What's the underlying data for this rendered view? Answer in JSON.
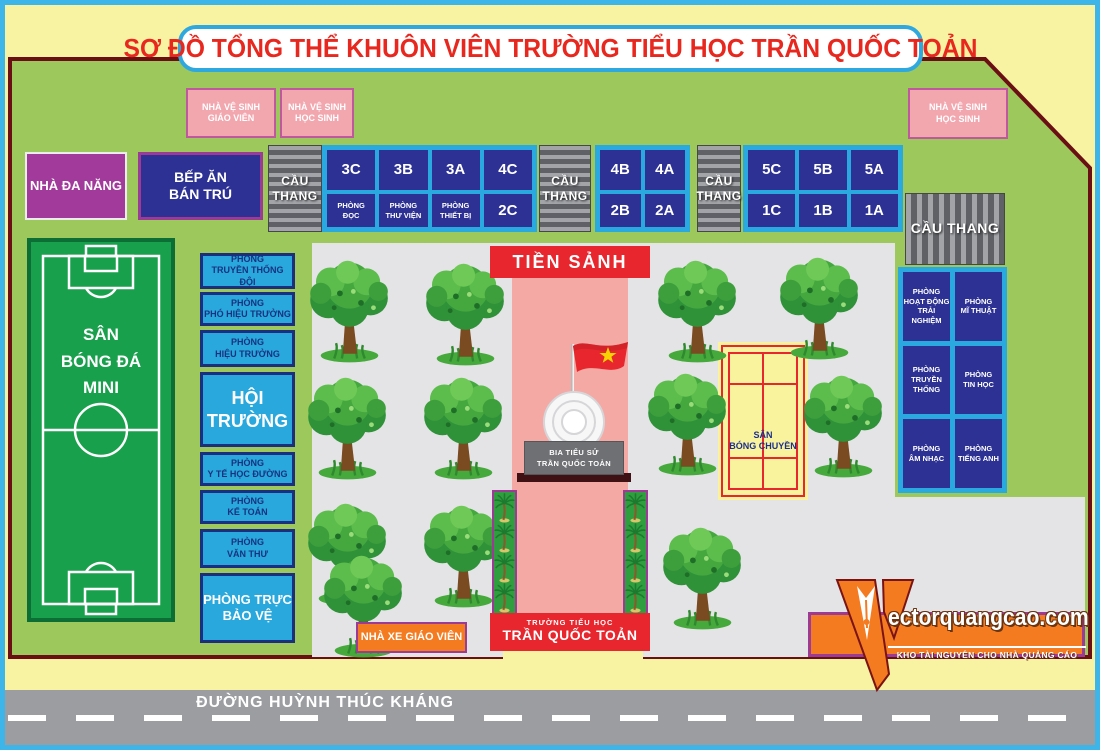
{
  "title": "SƠ ĐỒ TỔNG THỂ KHUÔN VIÊN TRƯỜNG TIỂU HỌC TRẦN QUỐC TOẢN",
  "colors": {
    "outer_border": "#3db5e8",
    "background_yellow": "#f8f3a2",
    "campus_green": "#9dc95c",
    "campus_border_red": "#6a0f14",
    "title_red": "#e8281e",
    "room_navy": "#2c3193",
    "frame_light_blue": "#2aa9e1",
    "toilet_pink": "#f2a6ae",
    "purple": "#a13a9b",
    "orange": "#f47b20",
    "courtyard_gray": "#e4e4e6",
    "walkway_pink": "#f4a9a4",
    "banner_red": "#e8262d",
    "field_green": "#18a04c",
    "court_yellow": "#faf39e",
    "road_gray": "#9b9da1"
  },
  "facilities": {
    "toilet_teacher": "NHÀ VỆ SINH\nGIÁO VIÊN",
    "toilet_student": "NHÀ VỆ SINH\nHỌC SINH",
    "multi_purpose_hall": "NHÀ ĐA NĂNG",
    "kitchen": "BẾP ĂN\nBÁN TRÚ",
    "stairs": "CẦU\nTHANG",
    "stairs_wide": "CẦU THANG",
    "teacher_parking": "NHÀ XE GIÁO VIÊN"
  },
  "classrooms": {
    "block1_top": [
      "3C",
      "3B",
      "3A",
      "4C"
    ],
    "block1_bottom": [
      "PHÒNG\nĐỌC",
      "PHÒNG\nTHƯ VIỆN",
      "PHÒNG\nTHIẾT BỊ",
      "2C"
    ],
    "block2_top": [
      "4B",
      "4A"
    ],
    "block2_bottom": [
      "2B",
      "2A"
    ],
    "block3_top": [
      "5C",
      "5B",
      "5A"
    ],
    "block3_bottom": [
      "1C",
      "1B",
      "1A"
    ]
  },
  "left_rooms": [
    "PHÒNG\nTRUYỀN THỐNG ĐỘI",
    "PHÒNG\nPHÓ HIỆU TRƯỞNG",
    "PHÒNG\nHIỆU TRƯỞNG",
    "HỘI\nTRƯỜNG",
    "PHÒNG\nY TẾ HỌC ĐƯỜNG",
    "PHÒNG\nKẾ TOÁN",
    "PHÒNG\nVĂN THƯ",
    "PHÒNG TRỰC\nBẢO VỆ"
  ],
  "right_rooms": [
    "PHÒNG\nHOẠT ĐỘNG\nTRẢI NGHIỆM",
    "PHÒNG\nMĨ THUẬT",
    "PHÒNG\nTRUYỀN THỐNG",
    "PHÒNG\nTIN HỌC",
    "PHÒNG\nÂM NHẠC",
    "PHÒNG\nTIẾNG ANH"
  ],
  "grounds": {
    "soccer_field": "SÂN\nBÓNG ĐÁ\nMINI",
    "volleyball_court": "SÂN\nBÓNG CHUYỀN",
    "front_hall": "TIỀN SẢNH",
    "memorial": "BIA TIỂU SỬ\nTRẦN QUỐC TOẢN"
  },
  "gate": {
    "line1": "TRƯỜNG TIỂU HỌC",
    "line2": "TRẦN QUỐC TOẢN"
  },
  "road": "ĐƯỜNG HUỲNH THÚC KHÁNG",
  "watermark": {
    "brand": "ectorquangcao.com",
    "tagline": "KHO TÀI NGUYÊN CHO NHÀ QUẢNG CÁO"
  }
}
